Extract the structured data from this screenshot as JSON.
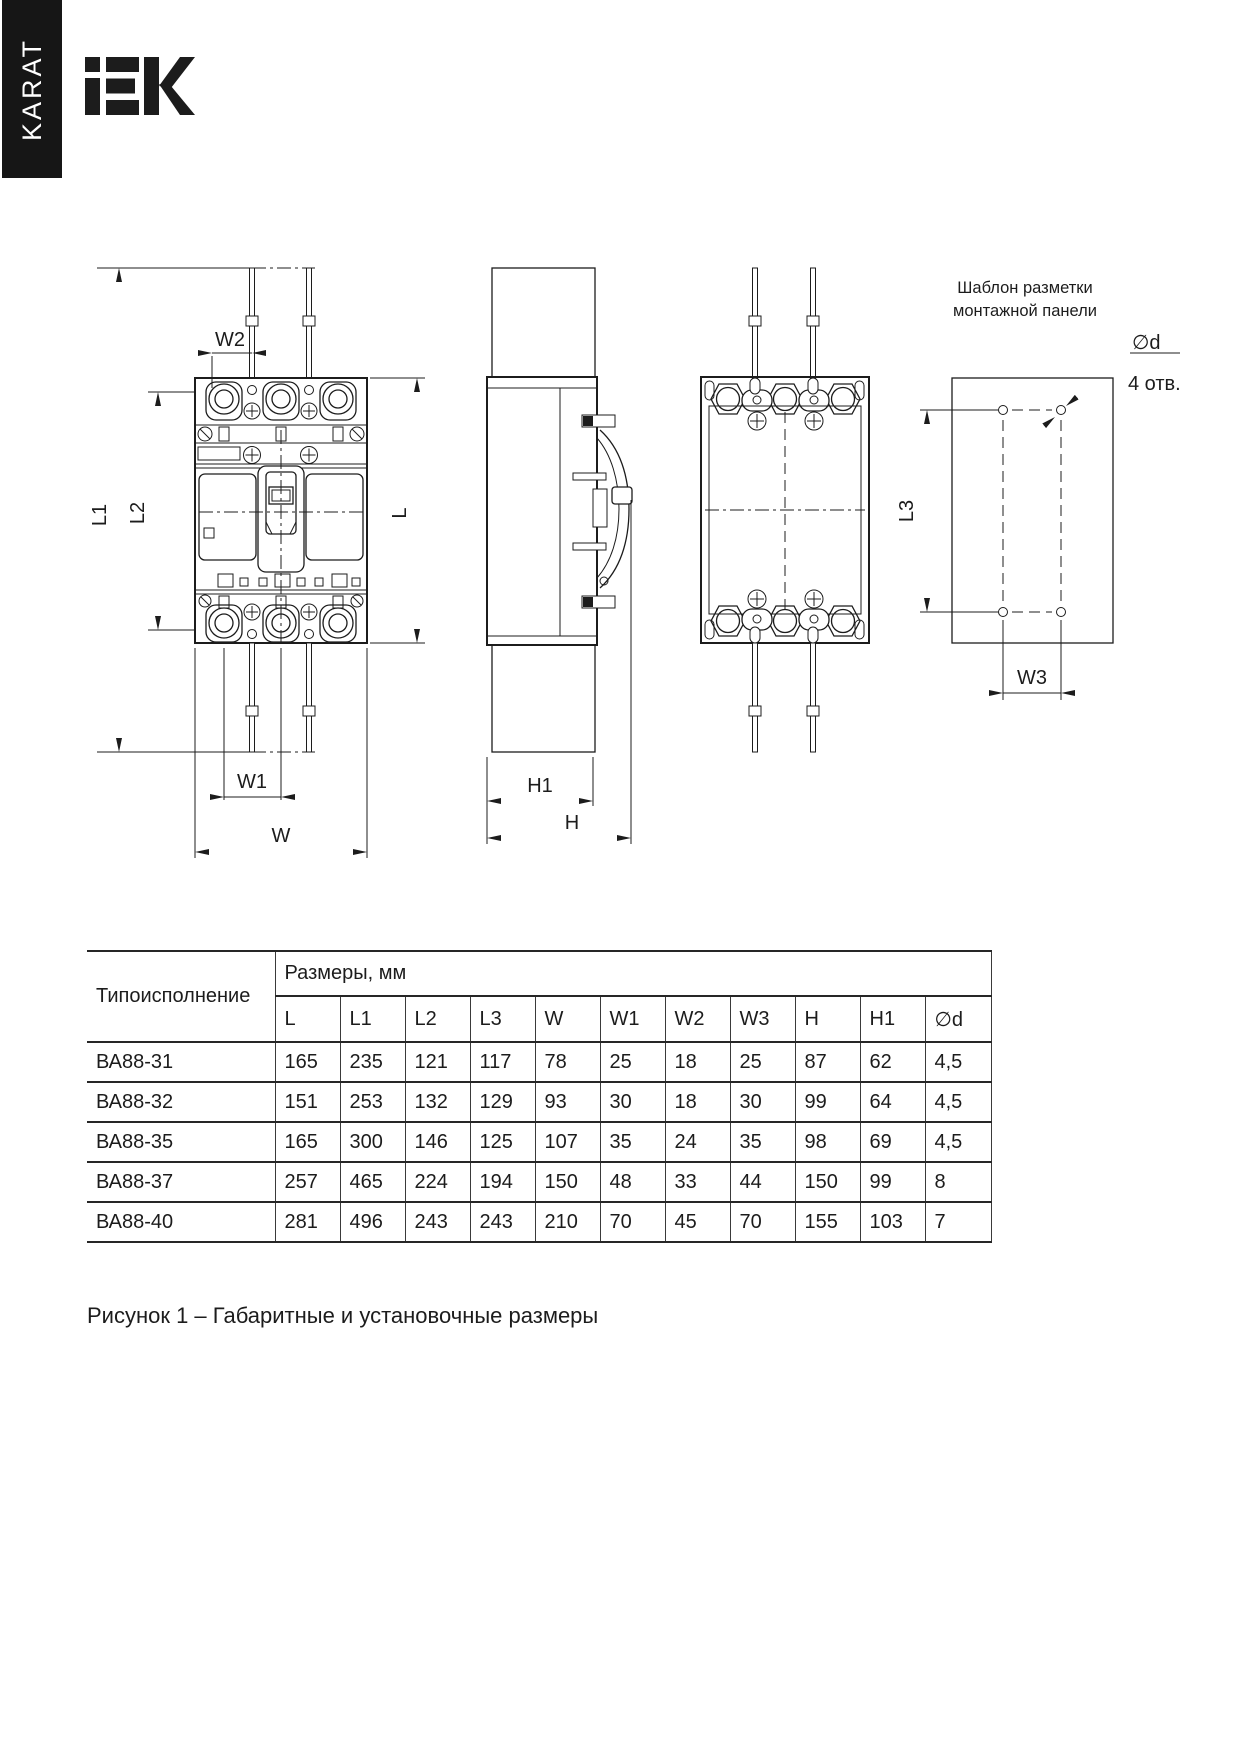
{
  "brand": {
    "tab_label": "KARAT",
    "logo_name": "IEK"
  },
  "drawing": {
    "labels": {
      "w2": "W2",
      "l1": "L1",
      "l2": "L2",
      "l": "L",
      "w1": "W1",
      "w": "W",
      "h1": "H1",
      "h": "H",
      "l3": "L3",
      "w3": "W3",
      "diameter": "∅d",
      "holes_note": "4 отв.",
      "template_title_line1": "Шаблон разметки",
      "template_title_line2": "монтажной панели"
    }
  },
  "table": {
    "col1_header": "Типоисполнение",
    "group_header": "Размеры, мм",
    "columns": [
      "L",
      "L1",
      "L2",
      "L3",
      "W",
      "W1",
      "W2",
      "W3",
      "H",
      "H1",
      "∅d"
    ],
    "rows": [
      {
        "name": "ВА88-31",
        "values": [
          "165",
          "235",
          "121",
          "117",
          "78",
          "25",
          "18",
          "25",
          "87",
          "62",
          "4,5"
        ]
      },
      {
        "name": "ВА88-32",
        "values": [
          "151",
          "253",
          "132",
          "129",
          "93",
          "30",
          "18",
          "30",
          "99",
          "64",
          "4,5"
        ]
      },
      {
        "name": "ВА88-35",
        "values": [
          "165",
          "300",
          "146",
          "125",
          "107",
          "35",
          "24",
          "35",
          "98",
          "69",
          "4,5"
        ]
      },
      {
        "name": "ВА88-37",
        "values": [
          "257",
          "465",
          "224",
          "194",
          "150",
          "48",
          "33",
          "44",
          "150",
          "99",
          "8"
        ]
      },
      {
        "name": "ВА88-40",
        "values": [
          "281",
          "496",
          "243",
          "243",
          "210",
          "70",
          "45",
          "70",
          "155",
          "103",
          "7"
        ]
      }
    ]
  },
  "caption": "Рисунок 1 – Габаритные и установочные размеры"
}
